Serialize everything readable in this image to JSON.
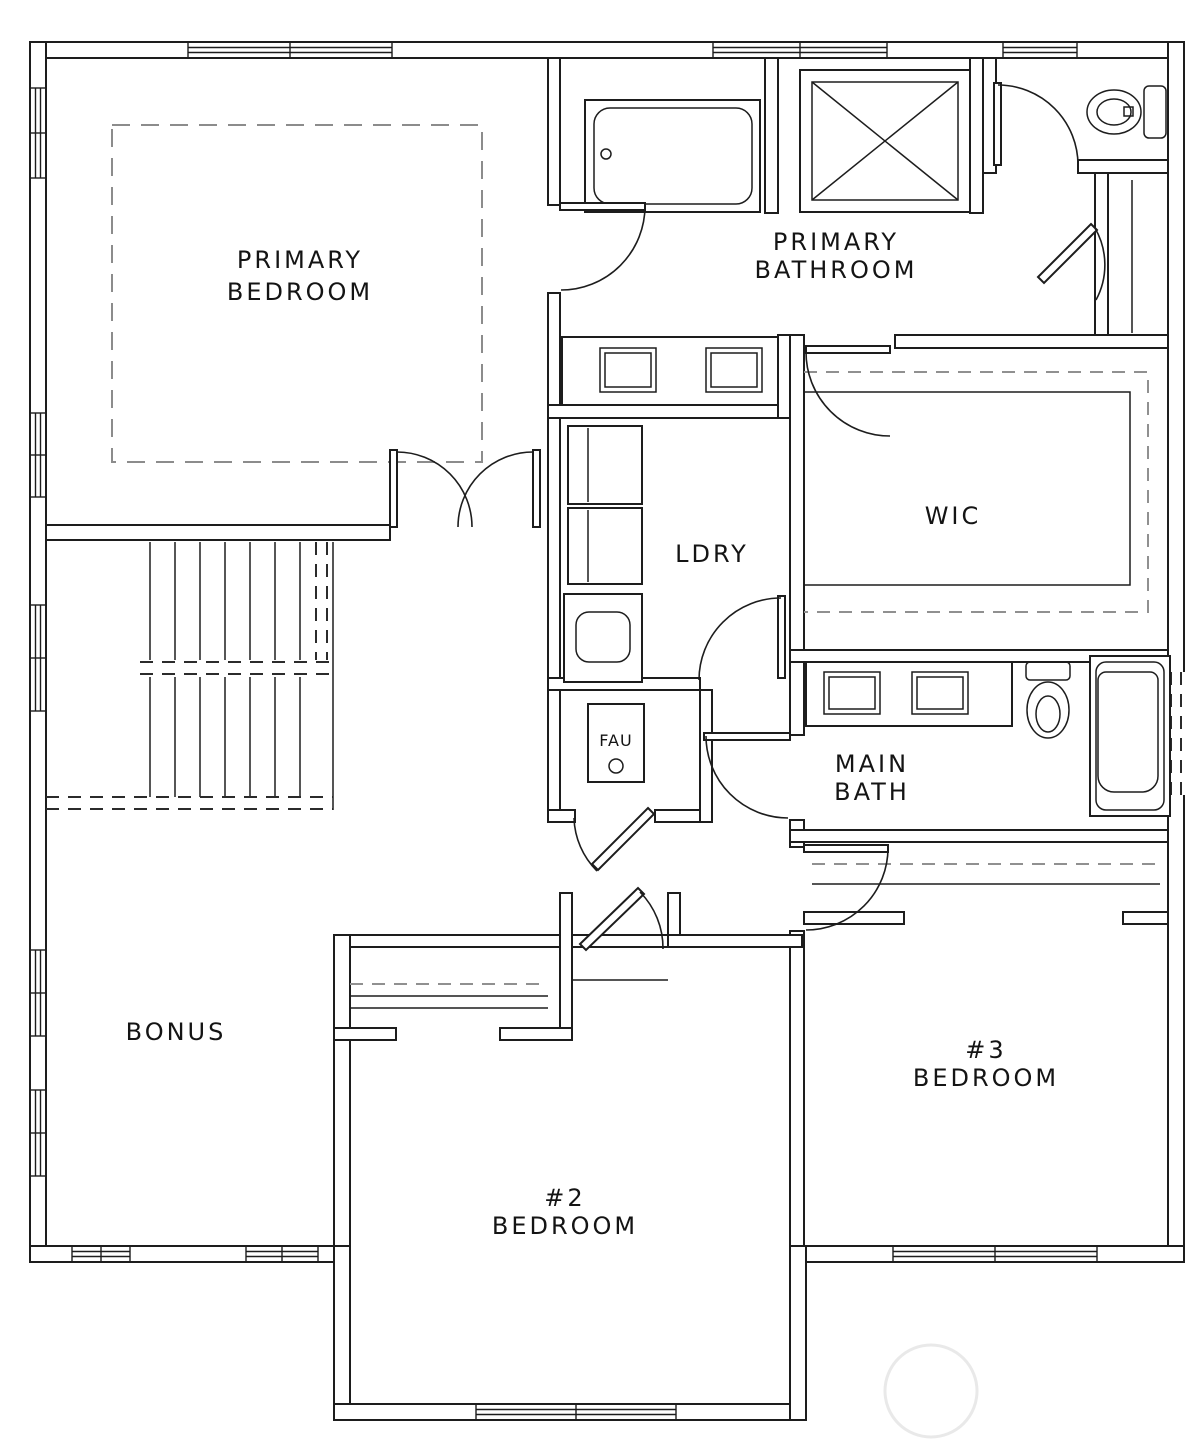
{
  "plan": {
    "colors": {
      "background": "#ffffff",
      "line": "#1d1d1d",
      "dashed_guide": "#8c8c8c",
      "watermark": "#e9e9e9"
    },
    "rooms": [
      {
        "name": "primary-bedroom",
        "line1": "PRIMARY",
        "line2": "BEDROOM"
      },
      {
        "name": "primary-bathroom",
        "line1": "PRIMARY",
        "line2": "BATHROOM"
      },
      {
        "name": "walk-in-closet",
        "line1": "WIC"
      },
      {
        "name": "laundry",
        "line1": "LDRY"
      },
      {
        "name": "fau-closet",
        "line1": "FAU"
      },
      {
        "name": "main-bathroom",
        "line1": "MAIN",
        "line2": "BATH"
      },
      {
        "name": "bonus-room",
        "line1": "BONUS"
      },
      {
        "name": "bedroom-2",
        "line1": "#2",
        "line2": "BEDROOM"
      },
      {
        "name": "bedroom-3",
        "line1": "#3",
        "line2": "BEDROOM"
      }
    ],
    "fixtures": [
      {
        "name": "bathtub-primary"
      },
      {
        "name": "shower-stall"
      },
      {
        "name": "toilet-primary"
      },
      {
        "name": "vanity-double-sink-primary"
      },
      {
        "name": "washer"
      },
      {
        "name": "dryer"
      },
      {
        "name": "utility-sink"
      },
      {
        "name": "furnace-unit"
      },
      {
        "name": "vanity-double-sink-main"
      },
      {
        "name": "toilet-main"
      },
      {
        "name": "bathtub-main"
      },
      {
        "name": "staircase"
      }
    ]
  }
}
